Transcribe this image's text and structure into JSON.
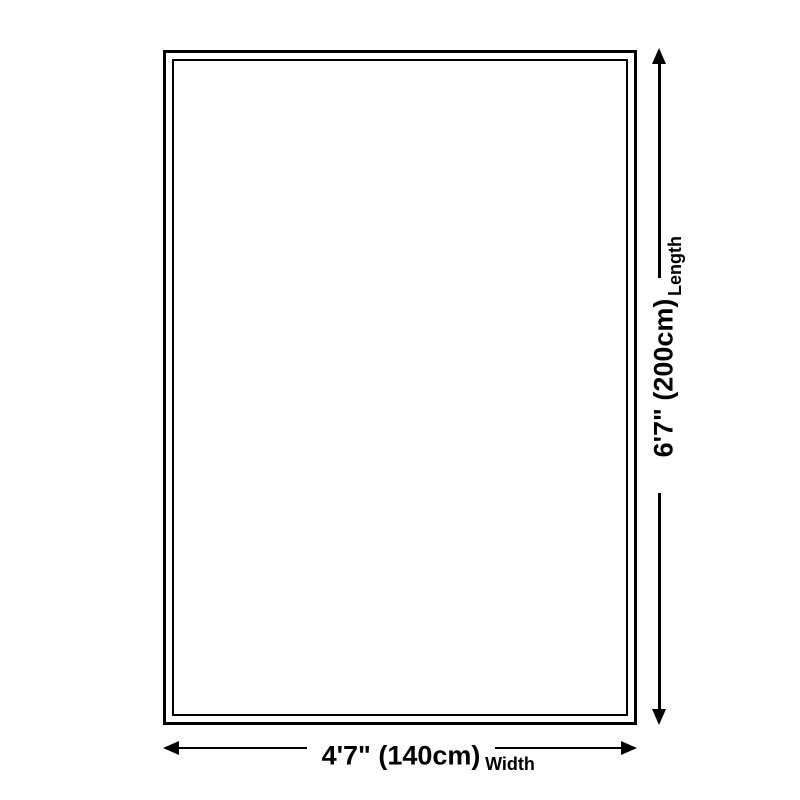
{
  "diagram": {
    "type": "product-size-diagram",
    "dimensions": {
      "length": {
        "value": "6'7\" (200cm)",
        "label": "Length"
      },
      "width": {
        "value": "4'7\" (140cm)",
        "label": "Width"
      }
    }
  },
  "colors": {
    "line": "#000000",
    "background": "#ffffff"
  }
}
